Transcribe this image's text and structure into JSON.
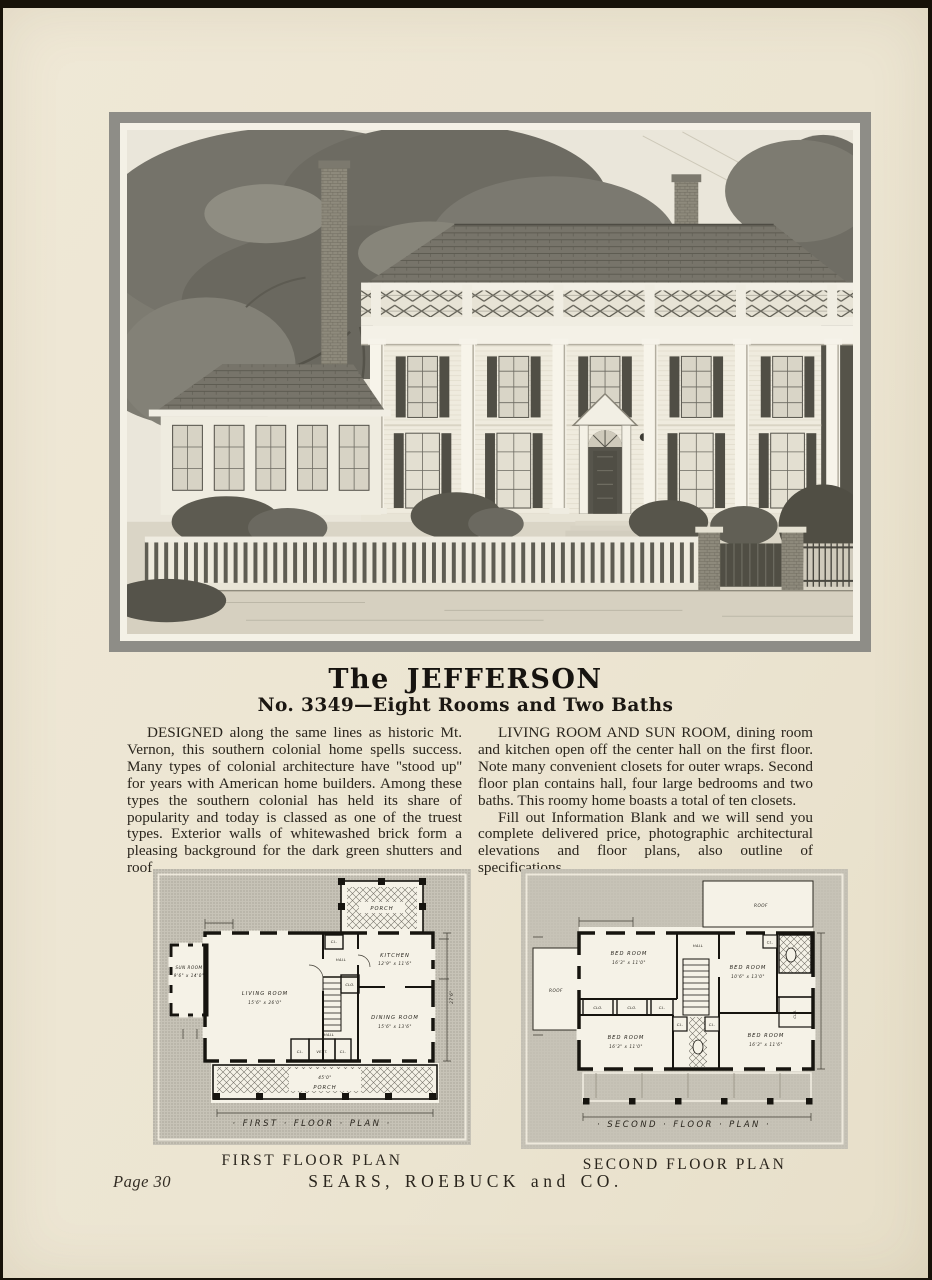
{
  "colors": {
    "paper": "#ece5d2",
    "frame_gray": "#8e8d87",
    "ink": "#2a251d",
    "plan_ground": "#c7c3b7"
  },
  "header": {
    "title": "The JEFFERSON",
    "subtitle": "No. 3349—Eight Rooms and Two Baths"
  },
  "copy": {
    "left": "DESIGNED along the same lines as historic Mt. Vernon, this southern colonial home spells success. Many types of colonial architecture have ''stood up'' for years with American home builders. Among these types the southern colonial has held its share of popularity and today is classed as one of the truest types. Exterior walls of whitewashed brick form a pleasing background for the dark green shutters and roof.",
    "right1": "LIVING ROOM AND SUN ROOM, dining room and kitchen open off the center hall on the first floor. Note many convenient closets for outer wraps. Second floor plan contains hall, four large bedrooms and two baths. This roomy home boasts a total of ten closets.",
    "right2": "Fill out Information Blank and we will send you complete delivered price, photographic architectural elevations and floor plans, also outline of specifications."
  },
  "illustration": {
    "description": "Southern colonial brick house with two-story colonnade, roof balustrade, shuttered windows, sun-room wing, picket fence and large trees"
  },
  "plan1": {
    "caption": "FIRST FLOOR PLAN",
    "script_label": "· FIRST · FLOOR · PLAN ·",
    "labels": {
      "porch_rear": "PORCH",
      "sun_room": "SUN ROOM",
      "sun_room_dim": "9'6\" x 14'0\"",
      "living": "LIVING ROOM",
      "living_dim": "15'6\" x 26'0\"",
      "hall_rear": "HALL",
      "kitchen": "KITCHEN",
      "kitchen_dim": "12'9\" x 11'6\"",
      "cl_top": "CL.",
      "clo": "CLO.",
      "hall": "HALL",
      "dining": "DINING ROOM",
      "dining_dim": "15'6\" x 13'6\"",
      "cl_left": "CL.",
      "vest": "VEST.",
      "cl_right": "CL.",
      "porch_width": "45'0\"",
      "porch": "PORCH",
      "depth": "27'6\""
    }
  },
  "plan2": {
    "caption": "SECOND FLOOR PLAN",
    "script_label": "· SECOND · FLOOR · PLAN ·",
    "labels": {
      "roof_left": "ROOF",
      "roof_right": "ROOF",
      "bed1": "BED ROOM",
      "bed1_dim": "16'3\" x 11'0\"",
      "hall": "HALL",
      "bed2": "BED ROOM",
      "bed2_dim": "10'6\" x 13'0\"",
      "cl_top": "CL.",
      "clo_a": "CLO.",
      "clo_b": "CLO.",
      "cl_row": "CL.",
      "clo_right": "CLO.",
      "cl_ba": "CL.",
      "cl_bb": "CL.",
      "bed3": "BED ROOM",
      "bed3_dim": "16'3\" x 11'0\"",
      "bed4": "BED ROOM",
      "bed4_dim": "16'3\" x 11'6\""
    }
  },
  "footer": {
    "page_label": "Page 30",
    "company": "SEARS, ROEBUCK and CO."
  }
}
